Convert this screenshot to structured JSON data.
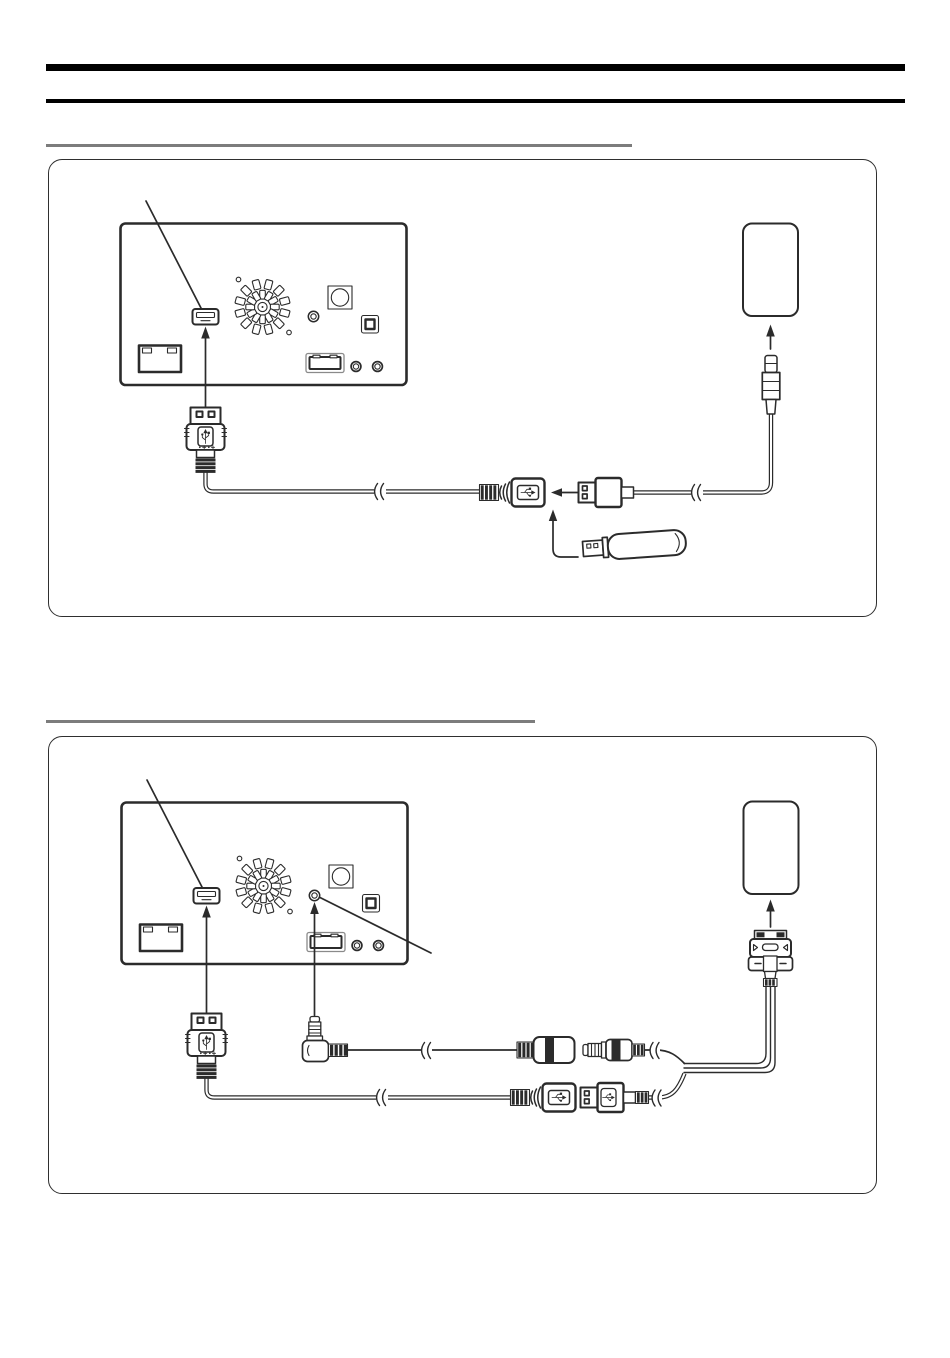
{
  "document": {
    "kind": "connection-diagram-page",
    "visible_text": "none"
  },
  "colors": {
    "ink": "#2b2b2b",
    "rule-heavy": "#000000",
    "rule-heading": "#7c7c7c",
    "panel-border": "#2f2f2f",
    "paper": "#ffffff"
  },
  "header": {
    "rules": [
      "thick-black-rule",
      "thin-black-rule"
    ]
  },
  "sections": [
    {
      "id": 1,
      "heading_text": "",
      "diagram": {
        "components": [
          "head-unit-rear-panel",
          "usb-port",
          "cooling-fan",
          "round-connector",
          "aux-jack",
          "square-connector",
          "wide-connector",
          "rca-jacks",
          "harness-connector",
          "usb-plug",
          "usb-extension-cable",
          "usb-female-connector",
          "usb-cable-plug",
          "portable-device",
          "device-plug",
          "usb-memory"
        ],
        "callout_lines": 1,
        "connection_arrows": 4,
        "cable_break_marks": 2
      }
    },
    {
      "id": 2,
      "heading_text": "",
      "diagram": {
        "components": [
          "head-unit-rear-panel",
          "usb-port",
          "aux-jack",
          "usb-plug",
          "usb-extension-cable",
          "right-angle-mini-plug",
          "mini-plug-cable",
          "mini-jack-coupler-female",
          "mini-plug-male",
          "usb-female-connector",
          "usb-plug-male",
          "y-split-cable",
          "dock-connector",
          "portable-device"
        ],
        "callout_lines": 2,
        "connection_arrows": 3,
        "cable_break_marks": 4
      }
    }
  ]
}
